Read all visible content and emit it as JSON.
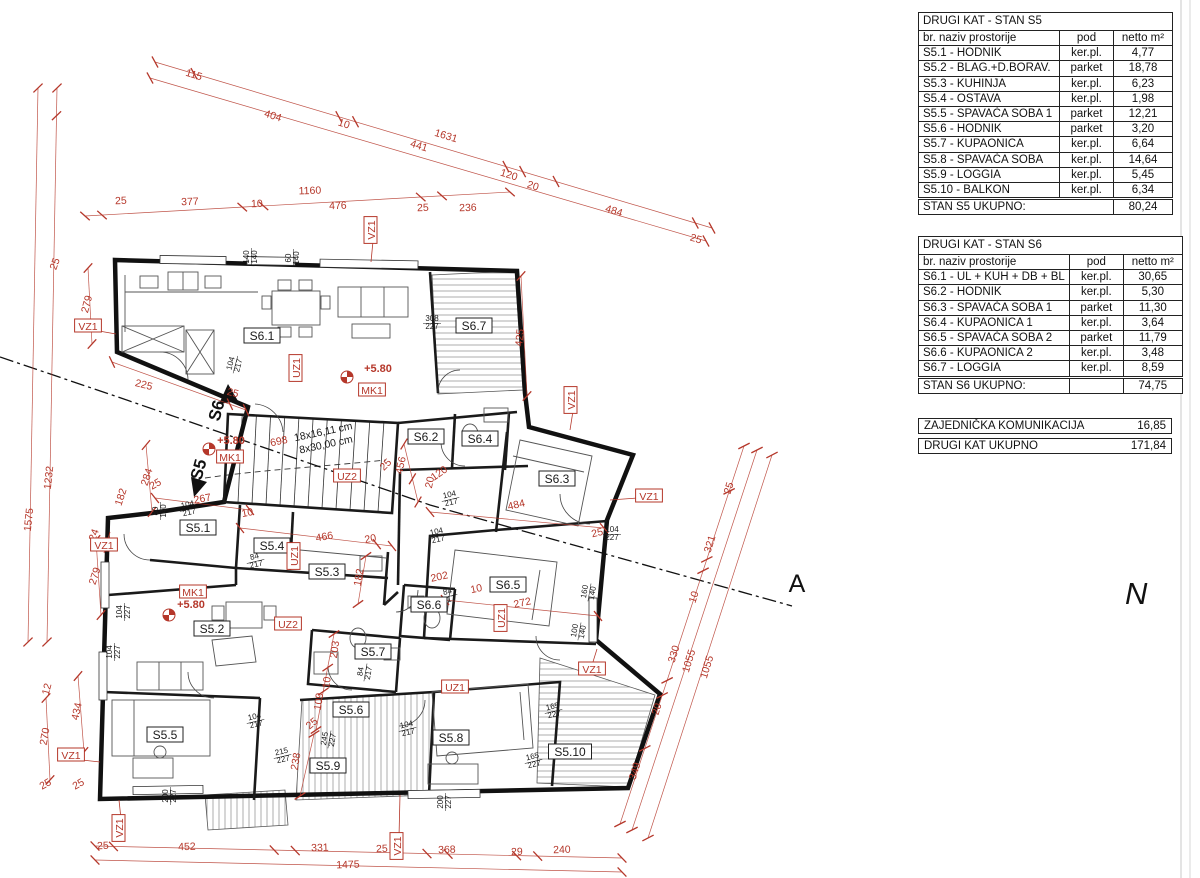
{
  "tables": {
    "s5": {
      "title": "DRUGI KAT - STAN S5",
      "headers": [
        "br.  naziv prostorije",
        "pod",
        "netto m²"
      ],
      "rows": [
        [
          "S5.1 - HODNIK",
          "ker.pl.",
          "4,77"
        ],
        [
          "S5.2 - BLAG.+D.BORAV.",
          "parket",
          "18,78"
        ],
        [
          "S5.3 - KUHINJA",
          "ker.pl.",
          "6,23"
        ],
        [
          "S5.4 - OSTAVA",
          "ker.pl.",
          "1,98"
        ],
        [
          "S5.5 - SPAVAĆA SOBA 1",
          "parket",
          "12,21"
        ],
        [
          "S5.6 - HODNIK",
          "parket",
          "3,20"
        ],
        [
          "S5.7 - KUPAONICA",
          "ker.pl.",
          "6,64"
        ],
        [
          "S5.8 - SPAVAĆA SOBA",
          "ker.pl.",
          "14,64"
        ],
        [
          "S5.9 - LOGGIA",
          "ker.pl.",
          "5,45"
        ],
        [
          "S5.10 - BALKON",
          "ker.pl.",
          "6,34"
        ]
      ],
      "total_label": "STAN S5  UKUPNO:",
      "total_value": "80,24"
    },
    "s6": {
      "title": "DRUGI KAT - STAN S6",
      "headers": [
        "br.  naziv prostorije",
        "pod",
        "netto m²"
      ],
      "rows": [
        [
          "S6.1 - UL + KUH + DB + BL",
          "ker.pl.",
          "30,65"
        ],
        [
          "S6.2 - HODNIK",
          "ker.pl.",
          "5,30"
        ],
        [
          "S6.3 - SPAVAĆA SOBA 1",
          "parket",
          "11,30"
        ],
        [
          "S6.4 - KUPAONICA 1",
          "ker.pl.",
          "3,64"
        ],
        [
          "S6.5 - SPAVAĆA SOBA 2",
          "parket",
          "11,79"
        ],
        [
          "S6.6 - KUPAONICA 2",
          "ker.pl.",
          "3,48"
        ],
        [
          "S6.7 - LOGGIA",
          "ker.pl.",
          "8,59"
        ]
      ],
      "total_label": "STAN S6  UKUPNO:",
      "total_value": "74,75"
    },
    "summary": [
      {
        "label": "ZAJEDNIČKA KOMUNIKACIJA",
        "value": "16,85"
      },
      {
        "label": "DRUGI KAT  UKUPNO",
        "value": "171,84"
      }
    ]
  },
  "plan": {
    "colors": {
      "red": "#b5372a",
      "black": "#1a1a1a"
    },
    "letters": {
      "section": "A",
      "north": "N"
    },
    "stair": {
      "num": "698",
      "line1": "18x16,11 cm",
      "line2": "8x30,00 cm"
    },
    "arrows": {
      "up": "S6",
      "down": "S5"
    },
    "room_labels": [
      {
        "t": "S6.1",
        "x": 262,
        "y": 339
      },
      {
        "t": "S6.7",
        "x": 474,
        "y": 329
      },
      {
        "t": "S6.2",
        "x": 426,
        "y": 440
      },
      {
        "t": "S6.4",
        "x": 480,
        "y": 442
      },
      {
        "t": "S6.3",
        "x": 557,
        "y": 482
      },
      {
        "t": "S6.5",
        "x": 508,
        "y": 588
      },
      {
        "t": "S6.6",
        "x": 429,
        "y": 608
      },
      {
        "t": "S5.1",
        "x": 198,
        "y": 531
      },
      {
        "t": "S5.4",
        "x": 272,
        "y": 549
      },
      {
        "t": "S5.3",
        "x": 327,
        "y": 575
      },
      {
        "t": "S5.2",
        "x": 212,
        "y": 632
      },
      {
        "t": "S5.7",
        "x": 373,
        "y": 655
      },
      {
        "t": "S5.6",
        "x": 351,
        "y": 713
      },
      {
        "t": "S5.5",
        "x": 165,
        "y": 738
      },
      {
        "t": "S5.9",
        "x": 328,
        "y": 769
      },
      {
        "t": "S5.8",
        "x": 451,
        "y": 741
      },
      {
        "t": "S5.10",
        "x": 570,
        "y": 755
      }
    ],
    "red_boxes": [
      {
        "t": "VZ1",
        "x": 373,
        "y": 230,
        "r": -90
      },
      {
        "t": "VZ1",
        "x": 88,
        "y": 328,
        "r": 0
      },
      {
        "t": "VZ1",
        "x": 104,
        "y": 547,
        "r": 0
      },
      {
        "t": "VZ1",
        "x": 71,
        "y": 757,
        "r": 0
      },
      {
        "t": "VZ1",
        "x": 121,
        "y": 828,
        "r": -90
      },
      {
        "t": "VZ1",
        "x": 399,
        "y": 846,
        "r": -90
      },
      {
        "t": "VZ1",
        "x": 573,
        "y": 400,
        "r": -90
      },
      {
        "t": "VZ1",
        "x": 649,
        "y": 498,
        "r": 0
      },
      {
        "t": "VZ1",
        "x": 592,
        "y": 671,
        "r": 0
      },
      {
        "t": "UZ1",
        "x": 298,
        "y": 368,
        "r": -90
      },
      {
        "t": "UZ1",
        "x": 296,
        "y": 556,
        "r": -90
      },
      {
        "t": "UZ1",
        "x": 503,
        "y": 618,
        "r": -90
      },
      {
        "t": "UZ1",
        "x": 455,
        "y": 689,
        "r": 0
      },
      {
        "t": "UZ2",
        "x": 347,
        "y": 478,
        "r": 0
      },
      {
        "t": "UZ2",
        "x": 288,
        "y": 626,
        "r": 0
      },
      {
        "t": "MK1",
        "x": 372,
        "y": 392,
        "r": 0
      },
      {
        "t": "MK1",
        "x": 230,
        "y": 459,
        "r": 0
      },
      {
        "t": "MK1",
        "x": 193,
        "y": 594,
        "r": 0
      }
    ],
    "levels": [
      {
        "t": "+5.80",
        "x": 378,
        "y": 372,
        "mx": 347,
        "my": 377
      },
      {
        "t": "+5.80",
        "x": 231,
        "y": 444,
        "mx": 209,
        "my": 449
      },
      {
        "t": "+5.80",
        "x": 191,
        "y": 608,
        "mx": 169,
        "my": 615
      }
    ],
    "dims": [
      {
        "t": "115",
        "x": 193,
        "y": 78,
        "r": 17
      },
      {
        "t": "404",
        "x": 272,
        "y": 119,
        "r": 17
      },
      {
        "t": "10",
        "x": 343,
        "y": 127,
        "r": 17
      },
      {
        "t": "441",
        "x": 418,
        "y": 149,
        "r": 17
      },
      {
        "t": "1631",
        "x": 445,
        "y": 139,
        "r": 17
      },
      {
        "t": "120",
        "x": 508,
        "y": 178,
        "r": 17
      },
      {
        "t": "20",
        "x": 532,
        "y": 189,
        "r": 17
      },
      {
        "t": "484",
        "x": 613,
        "y": 214,
        "r": 17
      },
      {
        "t": "25",
        "x": 695,
        "y": 242,
        "r": 17
      },
      {
        "t": "1160",
        "x": 310,
        "y": 194,
        "r": -2
      },
      {
        "t": "25",
        "x": 121,
        "y": 204,
        "r": -2
      },
      {
        "t": "377",
        "x": 190,
        "y": 205,
        "r": -2
      },
      {
        "t": "10",
        "x": 257,
        "y": 207,
        "r": -2
      },
      {
        "t": "476",
        "x": 338,
        "y": 209,
        "r": -2
      },
      {
        "t": "25",
        "x": 423,
        "y": 211,
        "r": -2
      },
      {
        "t": "236",
        "x": 468,
        "y": 211,
        "r": -2
      },
      {
        "t": "25",
        "x": 58,
        "y": 265,
        "r": -70
      },
      {
        "t": "279",
        "x": 90,
        "y": 305,
        "r": -75
      },
      {
        "t": "1232",
        "x": 52,
        "y": 478,
        "r": -84
      },
      {
        "t": "1575",
        "x": 32,
        "y": 520,
        "r": -84
      },
      {
        "t": "225",
        "x": 143,
        "y": 388,
        "r": 14
      },
      {
        "t": "25",
        "x": 232,
        "y": 396,
        "r": 14
      },
      {
        "t": "284",
        "x": 150,
        "y": 478,
        "r": -72
      },
      {
        "t": "24",
        "x": 97,
        "y": 536,
        "r": -70
      },
      {
        "t": "182",
        "x": 124,
        "y": 498,
        "r": -72
      },
      {
        "t": "279",
        "x": 98,
        "y": 577,
        "r": -72
      },
      {
        "t": "12",
        "x": 50,
        "y": 690,
        "r": -75
      },
      {
        "t": "434",
        "x": 80,
        "y": 712,
        "r": -78
      },
      {
        "t": "270",
        "x": 48,
        "y": 737,
        "r": -80
      },
      {
        "t": "25",
        "x": 47,
        "y": 787,
        "r": -30
      },
      {
        "t": "25",
        "x": 80,
        "y": 787,
        "r": -30
      },
      {
        "t": "267",
        "x": 203,
        "y": 502,
        "r": -11
      },
      {
        "t": "10",
        "x": 248,
        "y": 516,
        "r": -11
      },
      {
        "t": "25",
        "x": 157,
        "y": 487,
        "r": -30
      },
      {
        "t": "466",
        "x": 325,
        "y": 540,
        "r": -11
      },
      {
        "t": "20",
        "x": 371,
        "y": 542,
        "r": -11
      },
      {
        "t": "182",
        "x": 362,
        "y": 578,
        "r": -80
      },
      {
        "t": "456",
        "x": 404,
        "y": 466,
        "r": -78
      },
      {
        "t": "120",
        "x": 441,
        "y": 476,
        "r": -35
      },
      {
        "t": "25",
        "x": 388,
        "y": 467,
        "r": -45
      },
      {
        "t": "20",
        "x": 433,
        "y": 483,
        "r": -78
      },
      {
        "t": "484",
        "x": 517,
        "y": 508,
        "r": -13
      },
      {
        "t": "25",
        "x": 598,
        "y": 536,
        "r": -13
      },
      {
        "t": "202",
        "x": 440,
        "y": 580,
        "r": -12
      },
      {
        "t": "10",
        "x": 477,
        "y": 592,
        "r": -12
      },
      {
        "t": "272",
        "x": 523,
        "y": 606,
        "r": -12
      },
      {
        "t": "203",
        "x": 338,
        "y": 650,
        "r": -82
      },
      {
        "t": "10",
        "x": 330,
        "y": 683,
        "r": -82
      },
      {
        "t": "109",
        "x": 322,
        "y": 702,
        "r": -82
      },
      {
        "t": "25",
        "x": 314,
        "y": 726,
        "r": -40
      },
      {
        "t": "238",
        "x": 299,
        "y": 762,
        "r": -80
      },
      {
        "t": "321",
        "x": 713,
        "y": 545,
        "r": -73
      },
      {
        "t": "10",
        "x": 697,
        "y": 598,
        "r": -73
      },
      {
        "t": "330",
        "x": 677,
        "y": 655,
        "r": -73
      },
      {
        "t": "1055",
        "x": 692,
        "y": 662,
        "r": -73
      },
      {
        "t": "1055",
        "x": 710,
        "y": 668,
        "r": -73
      },
      {
        "t": "20",
        "x": 660,
        "y": 710,
        "r": -73
      },
      {
        "t": "349",
        "x": 638,
        "y": 772,
        "r": -73
      },
      {
        "t": "25",
        "x": 732,
        "y": 489,
        "r": -73
      },
      {
        "t": "425",
        "x": 523,
        "y": 338,
        "r": -84
      },
      {
        "t": "25",
        "x": 103,
        "y": 849,
        "r": -2
      },
      {
        "t": "452",
        "x": 187,
        "y": 850,
        "r": -2
      },
      {
        "t": "331",
        "x": 320,
        "y": 851,
        "r": -2
      },
      {
        "t": "25",
        "x": 382,
        "y": 852,
        "r": -2
      },
      {
        "t": "368",
        "x": 447,
        "y": 853,
        "r": -2
      },
      {
        "t": "29",
        "x": 517,
        "y": 855,
        "r": -2
      },
      {
        "t": "240",
        "x": 562,
        "y": 853,
        "r": -2
      },
      {
        "t": "1475",
        "x": 348,
        "y": 868,
        "r": -2
      }
    ],
    "small_dims": [
      {
        "a": "140",
        "b": "140",
        "x": 249,
        "y": 257,
        "r": -90
      },
      {
        "a": "60",
        "b": "140",
        "x": 291,
        "y": 258,
        "r": -90
      },
      {
        "a": "308",
        "b": "227",
        "x": 432,
        "y": 321,
        "r": 0
      },
      {
        "a": "104",
        "b": "217",
        "x": 233,
        "y": 364,
        "r": -75
      },
      {
        "a": "104",
        "b": "217",
        "x": 450,
        "y": 497,
        "r": -13
      },
      {
        "a": "104",
        "b": "217",
        "x": 437,
        "y": 534,
        "r": -13
      },
      {
        "a": "104",
        "b": "227",
        "x": 612,
        "y": 532,
        "r": 0
      },
      {
        "a": "104",
        "b": "227",
        "x": 122,
        "y": 612,
        "r": -90
      },
      {
        "a": "104",
        "b": "227",
        "x": 112,
        "y": 652,
        "r": -90
      },
      {
        "a": "84",
        "b": "217",
        "x": 363,
        "y": 672,
        "r": -80
      },
      {
        "a": "84",
        "b": "217",
        "x": 448,
        "y": 594,
        "r": -13
      },
      {
        "a": "84",
        "b": "217",
        "x": 255,
        "y": 559,
        "r": -13
      },
      {
        "a": "104",
        "b": "217",
        "x": 188,
        "y": 507,
        "r": -13
      },
      {
        "a": "80",
        "b": "140",
        "x": 158,
        "y": 511,
        "r": -90
      },
      {
        "a": "104",
        "b": "217",
        "x": 407,
        "y": 727,
        "r": -13
      },
      {
        "a": "104",
        "b": "217",
        "x": 255,
        "y": 719,
        "r": -13
      },
      {
        "a": "215",
        "b": "227",
        "x": 282,
        "y": 754,
        "r": -13
      },
      {
        "a": "245",
        "b": "227",
        "x": 327,
        "y": 739,
        "r": -80
      },
      {
        "a": "200",
        "b": "227",
        "x": 168,
        "y": 796,
        "r": -90
      },
      {
        "a": "200",
        "b": "227",
        "x": 443,
        "y": 802,
        "r": -90
      },
      {
        "a": "165",
        "b": "227",
        "x": 553,
        "y": 709,
        "r": -13
      },
      {
        "a": "165",
        "b": "227",
        "x": 533,
        "y": 759,
        "r": -13
      },
      {
        "a": "160",
        "b": "140",
        "x": 587,
        "y": 592,
        "r": -80
      },
      {
        "a": "100",
        "b": "140",
        "x": 577,
        "y": 631,
        "r": -80
      }
    ]
  }
}
